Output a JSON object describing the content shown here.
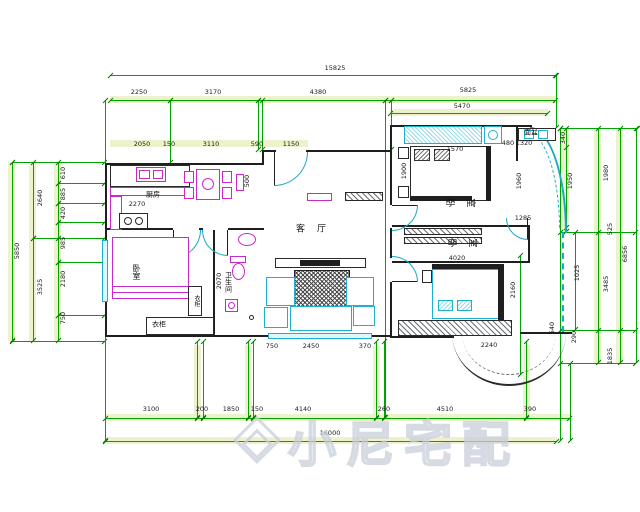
{
  "drawing": {
    "type": "residential floor plan (CAD)",
    "watermark": {
      "text": "小尼宅配"
    },
    "colors": {
      "dimension_line": "#00a400",
      "dimension_band": "#edf2cd",
      "wall": "#1f1f1f",
      "furniture_magenta": "#c929c9",
      "fixture_cyan": "#1fb0cd",
      "dimension_text": "#1a1a1a",
      "watermark": "#c9cfda"
    },
    "dimension_summary": {
      "top": {
        "overall": "15825",
        "segments": [
          "2250",
          "3170",
          "4380",
          "5825"
        ],
        "right_sub": "5470"
      },
      "bottom": {
        "overall": "16000",
        "segments": [
          "3100",
          "200",
          "1850",
          "150",
          "4140",
          "260",
          "4510",
          "390"
        ]
      },
      "left": {
        "overall": "5850",
        "segments": [
          "2640",
          "3525"
        ],
        "detail": [
          "610",
          "885",
          "420",
          "985",
          "2180",
          "750"
        ]
      },
      "right": {
        "overall": "6856",
        "segments": [
          "1980",
          "525",
          "3485",
          "1835"
        ],
        "detail": [
          "340",
          "1950",
          "1025",
          "540",
          "290"
        ]
      },
      "interior": [
        "2050",
        "150",
        "3110",
        "590",
        "1150",
        "2270",
        "500",
        "1570",
        "480",
        "1320",
        "1900",
        "1960",
        "1285",
        "4020",
        "2160",
        "2070",
        "750",
        "2450",
        "370",
        "2240"
      ]
    },
    "room_names": [
      "厨房",
      "客厅",
      "卧室",
      "卧室",
      "卧室",
      "卫生间",
      "衣柜",
      "衣柜",
      "面盆"
    ]
  },
  "annotations": {
    "dimensions": [
      {
        "t": "15825",
        "x": 335,
        "y": 68
      },
      {
        "t": "2250",
        "x": 139,
        "y": 92
      },
      {
        "t": "3170",
        "x": 213,
        "y": 92
      },
      {
        "t": "4380",
        "x": 318,
        "y": 92
      },
      {
        "t": "5825",
        "x": 468,
        "y": 90
      },
      {
        "t": "5470",
        "x": 462,
        "y": 106
      },
      {
        "t": "2050",
        "x": 142,
        "y": 144
      },
      {
        "t": "150",
        "x": 169,
        "y": 144
      },
      {
        "t": "3110",
        "x": 211,
        "y": 144
      },
      {
        "t": "590",
        "x": 257,
        "y": 144
      },
      {
        "t": "1150",
        "x": 291,
        "y": 144
      },
      {
        "t": "2270",
        "x": 137,
        "y": 204
      },
      {
        "t": "500",
        "x": 247,
        "y": 181,
        "r": -90
      },
      {
        "t": "1570",
        "x": 455,
        "y": 149
      },
      {
        "t": "480",
        "x": 508,
        "y": 143
      },
      {
        "t": "1320",
        "x": 524,
        "y": 143
      },
      {
        "t": "1900",
        "x": 404,
        "y": 171,
        "r": -90
      },
      {
        "t": "1960",
        "x": 519,
        "y": 181,
        "r": -90
      },
      {
        "t": "1285",
        "x": 523,
        "y": 218
      },
      {
        "t": "4020",
        "x": 457,
        "y": 258
      },
      {
        "t": "2160",
        "x": 513,
        "y": 290,
        "r": -90
      },
      {
        "t": "2070",
        "x": 219,
        "y": 281,
        "r": -90
      },
      {
        "t": "750",
        "x": 272,
        "y": 346
      },
      {
        "t": "2450",
        "x": 311,
        "y": 346
      },
      {
        "t": "370",
        "x": 365,
        "y": 346
      },
      {
        "t": "2240",
        "x": 489,
        "y": 345
      },
      {
        "t": "5850",
        "x": 17,
        "y": 251,
        "r": -90
      },
      {
        "t": "2640",
        "x": 40,
        "y": 198,
        "r": -90
      },
      {
        "t": "3525",
        "x": 40,
        "y": 287,
        "r": -90
      },
      {
        "t": "610",
        "x": 63,
        "y": 173,
        "r": -90
      },
      {
        "t": "885",
        "x": 63,
        "y": 194,
        "r": -90
      },
      {
        "t": "420",
        "x": 63,
        "y": 213,
        "r": -90
      },
      {
        "t": "985",
        "x": 63,
        "y": 243,
        "r": -90
      },
      {
        "t": "2180",
        "x": 63,
        "y": 279,
        "r": -90
      },
      {
        "t": "750",
        "x": 63,
        "y": 318,
        "r": -90
      },
      {
        "t": "340",
        "x": 563,
        "y": 138,
        "r": -90
      },
      {
        "t": "1950",
        "x": 570,
        "y": 181,
        "r": -90
      },
      {
        "t": "1025",
        "x": 577,
        "y": 273,
        "r": -90
      },
      {
        "t": "540",
        "x": 552,
        "y": 328,
        "r": -90
      },
      {
        "t": "290",
        "x": 574,
        "y": 337,
        "r": -90
      },
      {
        "t": "1980",
        "x": 606,
        "y": 173,
        "r": -90
      },
      {
        "t": "525",
        "x": 610,
        "y": 229,
        "r": -90
      },
      {
        "t": "3485",
        "x": 606,
        "y": 284,
        "r": -90
      },
      {
        "t": "1835",
        "x": 610,
        "y": 356,
        "r": -90
      },
      {
        "t": "6856",
        "x": 625,
        "y": 254,
        "r": -90
      },
      {
        "t": "3100",
        "x": 151,
        "y": 409
      },
      {
        "t": "200",
        "x": 202,
        "y": 409
      },
      {
        "t": "1850",
        "x": 231,
        "y": 409
      },
      {
        "t": "150",
        "x": 257,
        "y": 409
      },
      {
        "t": "4140",
        "x": 303,
        "y": 409
      },
      {
        "t": "260",
        "x": 384,
        "y": 409
      },
      {
        "t": "4510",
        "x": 445,
        "y": 409
      },
      {
        "t": "390",
        "x": 530,
        "y": 409
      },
      {
        "t": "16000",
        "x": 330,
        "y": 433
      }
    ],
    "rooms": [
      {
        "t": "厨房",
        "x": 153,
        "y": 195,
        "s": 7
      },
      {
        "t": "客厅",
        "x": 317,
        "y": 230,
        "s": 9,
        "ls": 12
      },
      {
        "t": "卧室",
        "x": 459,
        "y": 209,
        "s": 9,
        "ls": 12,
        "cr": true
      },
      {
        "t": "卧室",
        "x": 461,
        "y": 249,
        "s": 9,
        "ls": 12,
        "cr": true
      },
      {
        "t": "卧室",
        "x": 136,
        "y": 272,
        "s": 8,
        "v": true
      },
      {
        "t": "卫生间",
        "x": 228,
        "y": 282,
        "s": 7,
        "v": true
      },
      {
        "t": "衣柜",
        "x": 159,
        "y": 325,
        "s": 7
      },
      {
        "t": "衣柜",
        "x": 196,
        "y": 301,
        "s": 6,
        "v": true
      },
      {
        "t": "面盆",
        "x": 531,
        "y": 133,
        "s": 7
      }
    ]
  }
}
